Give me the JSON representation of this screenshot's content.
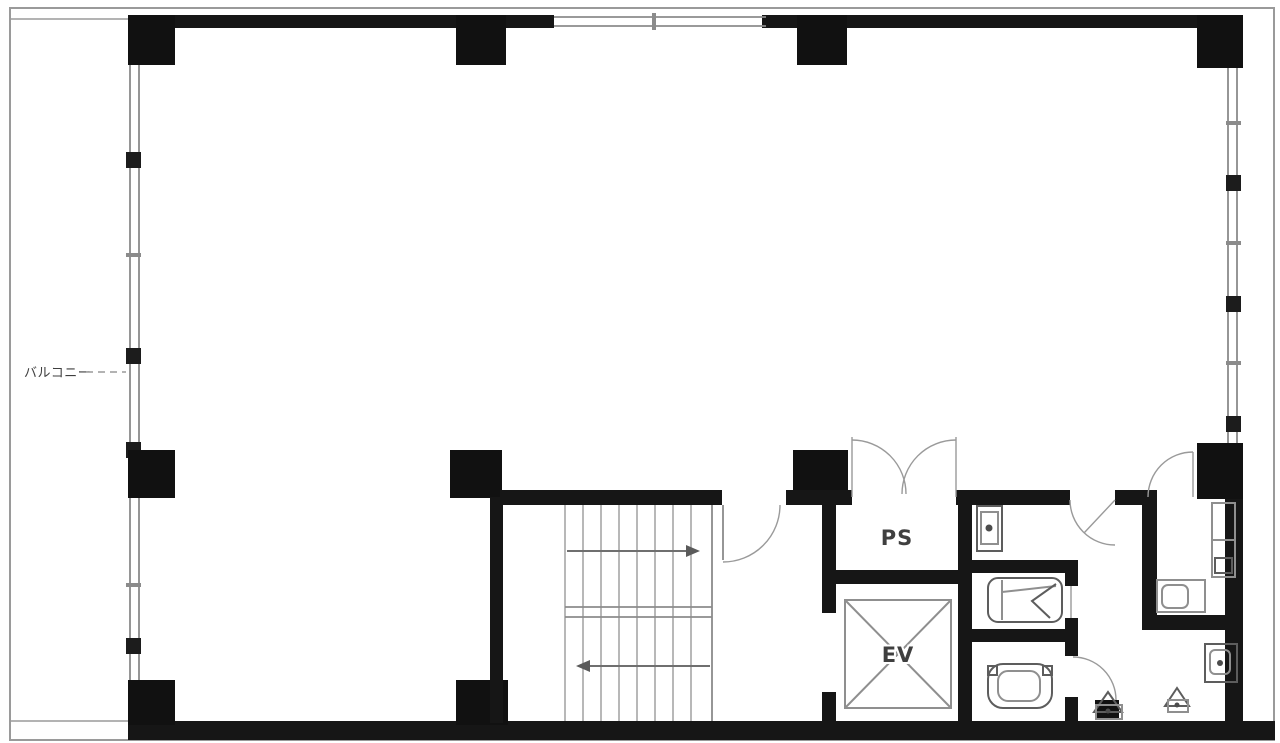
{
  "plan": {
    "title_note": "floor plan drawing",
    "background": "#ffffff",
    "colors": {
      "wall": "#161616",
      "column": "#111111",
      "thin_line": "#8b8b8b",
      "fixture_line": "#8f8f8f",
      "label_text": "#3f3f3f"
    },
    "labels": {
      "balcony": "バルコニー",
      "pipe_space": "PS",
      "elevator": "EV"
    },
    "fixtures": [
      "stairs-with-direction-arrows",
      "elevator-shaft-x-mark",
      "double-swing-door",
      "single-swing-doors",
      "squat-toilet",
      "western-toilet",
      "hand-wash-basin",
      "wall-hung-basin",
      "vanity-counter",
      "cleaners-sink",
      "floor-drain"
    ]
  }
}
